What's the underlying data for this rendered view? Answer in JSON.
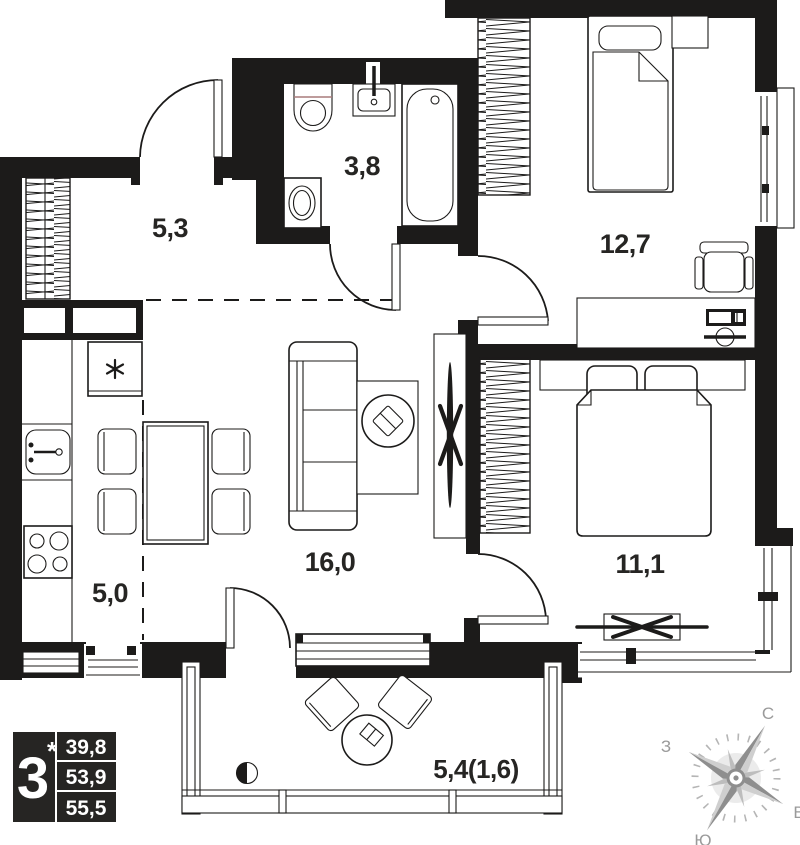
{
  "rooms": {
    "hallway": {
      "area": "5,3"
    },
    "bathroom": {
      "area": "3,8"
    },
    "bedroom1": {
      "area": "12,7"
    },
    "living": {
      "area": "16,0"
    },
    "bedroom2": {
      "area": "11,1"
    },
    "kitchen": {
      "area": "5,0"
    },
    "balcony": {
      "area": "5,4(1,6)"
    }
  },
  "badge": {
    "rooms_count": "3",
    "asterisk": "*",
    "areas": [
      "39,8",
      "53,9",
      "55,5"
    ]
  },
  "compass": {
    "north": "С",
    "west": "З",
    "south": "Ю",
    "east": "В"
  },
  "colors": {
    "wall": "#1c1b1a",
    "label": "#262523",
    "badge_bg": "#262523",
    "badge_text": "#ffffff",
    "compass_gray": "#9a9a9a",
    "toilet_seat_line": "#a97c7c",
    "background": "#ffffff"
  }
}
